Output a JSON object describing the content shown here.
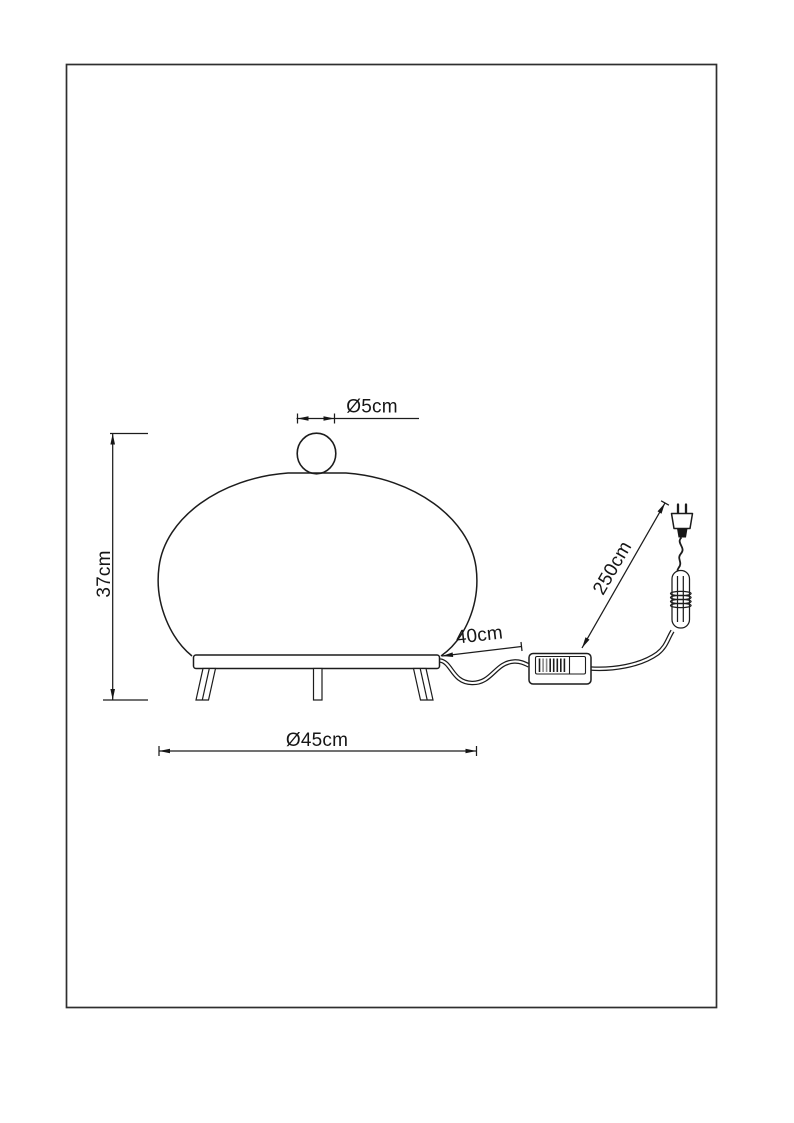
{
  "page": {
    "background_color": "#ffffff",
    "frame_color": "#2f2f2f",
    "line_color": "#1c1c1c",
    "solid_fill_color": "#161616"
  },
  "drawing": {
    "kind": "dimensioned product line drawing",
    "subject": "table lamp with cord, inline switch and plug",
    "labels": {
      "knob_diameter": "Ø5cm",
      "lamp_height": "37cm",
      "shade_diameter": "Ø45cm",
      "cord_lamp_to_switch": "40cm",
      "cord_total_length": "250cm"
    },
    "parts": [
      "lamp-shade",
      "finial-knob",
      "base-plate",
      "legs",
      "power-cord",
      "inline-switch",
      "cable-coil",
      "euro-plug"
    ]
  }
}
